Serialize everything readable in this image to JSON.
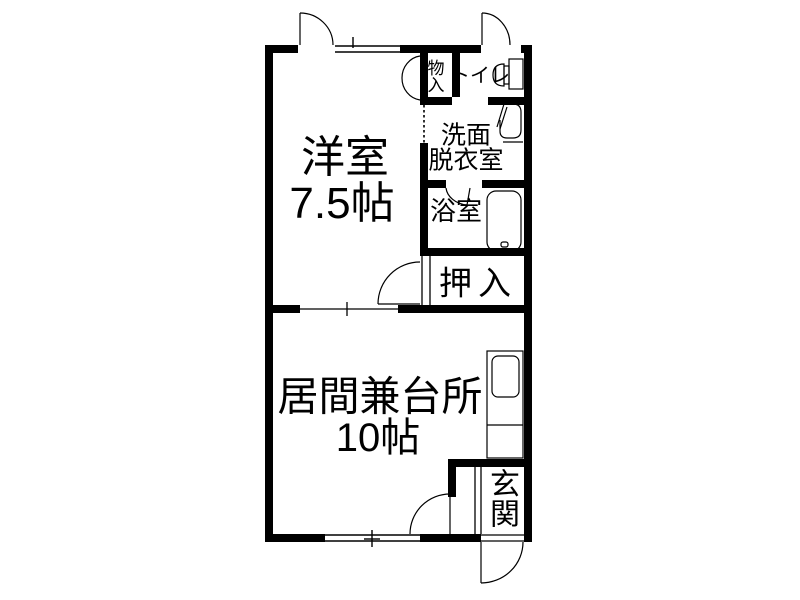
{
  "document": {
    "type": "japanese-apartment-floor-plan"
  },
  "colors": {
    "background": "#ffffff",
    "wall": "#000000",
    "line": "#000000",
    "text": "#000000"
  },
  "rooms": {
    "western": {
      "name": "洋室",
      "size": "7.5帖"
    },
    "living": {
      "name": "居間兼台所",
      "size": "10帖"
    },
    "storage": {
      "name": "物入"
    },
    "toilet": {
      "name": "トイレ"
    },
    "washroom": {
      "line1": "洗面",
      "line2": "脱衣室"
    },
    "bathroom": {
      "name": "浴室"
    },
    "closet": {
      "name": "押入"
    },
    "entrance": {
      "name": "玄関"
    }
  },
  "fixtures": {
    "toilet_icon": "toilet-bowl-and-tank",
    "washbasin_icon": "washbasin",
    "bathtub_icon": "bathtub",
    "kitchen_counter_icon": "kitchen-counter-with-sink",
    "entrance_step_icon": "entrance-step",
    "window_icons": "sliding-windows",
    "door_icons": "swing-door-arcs"
  }
}
